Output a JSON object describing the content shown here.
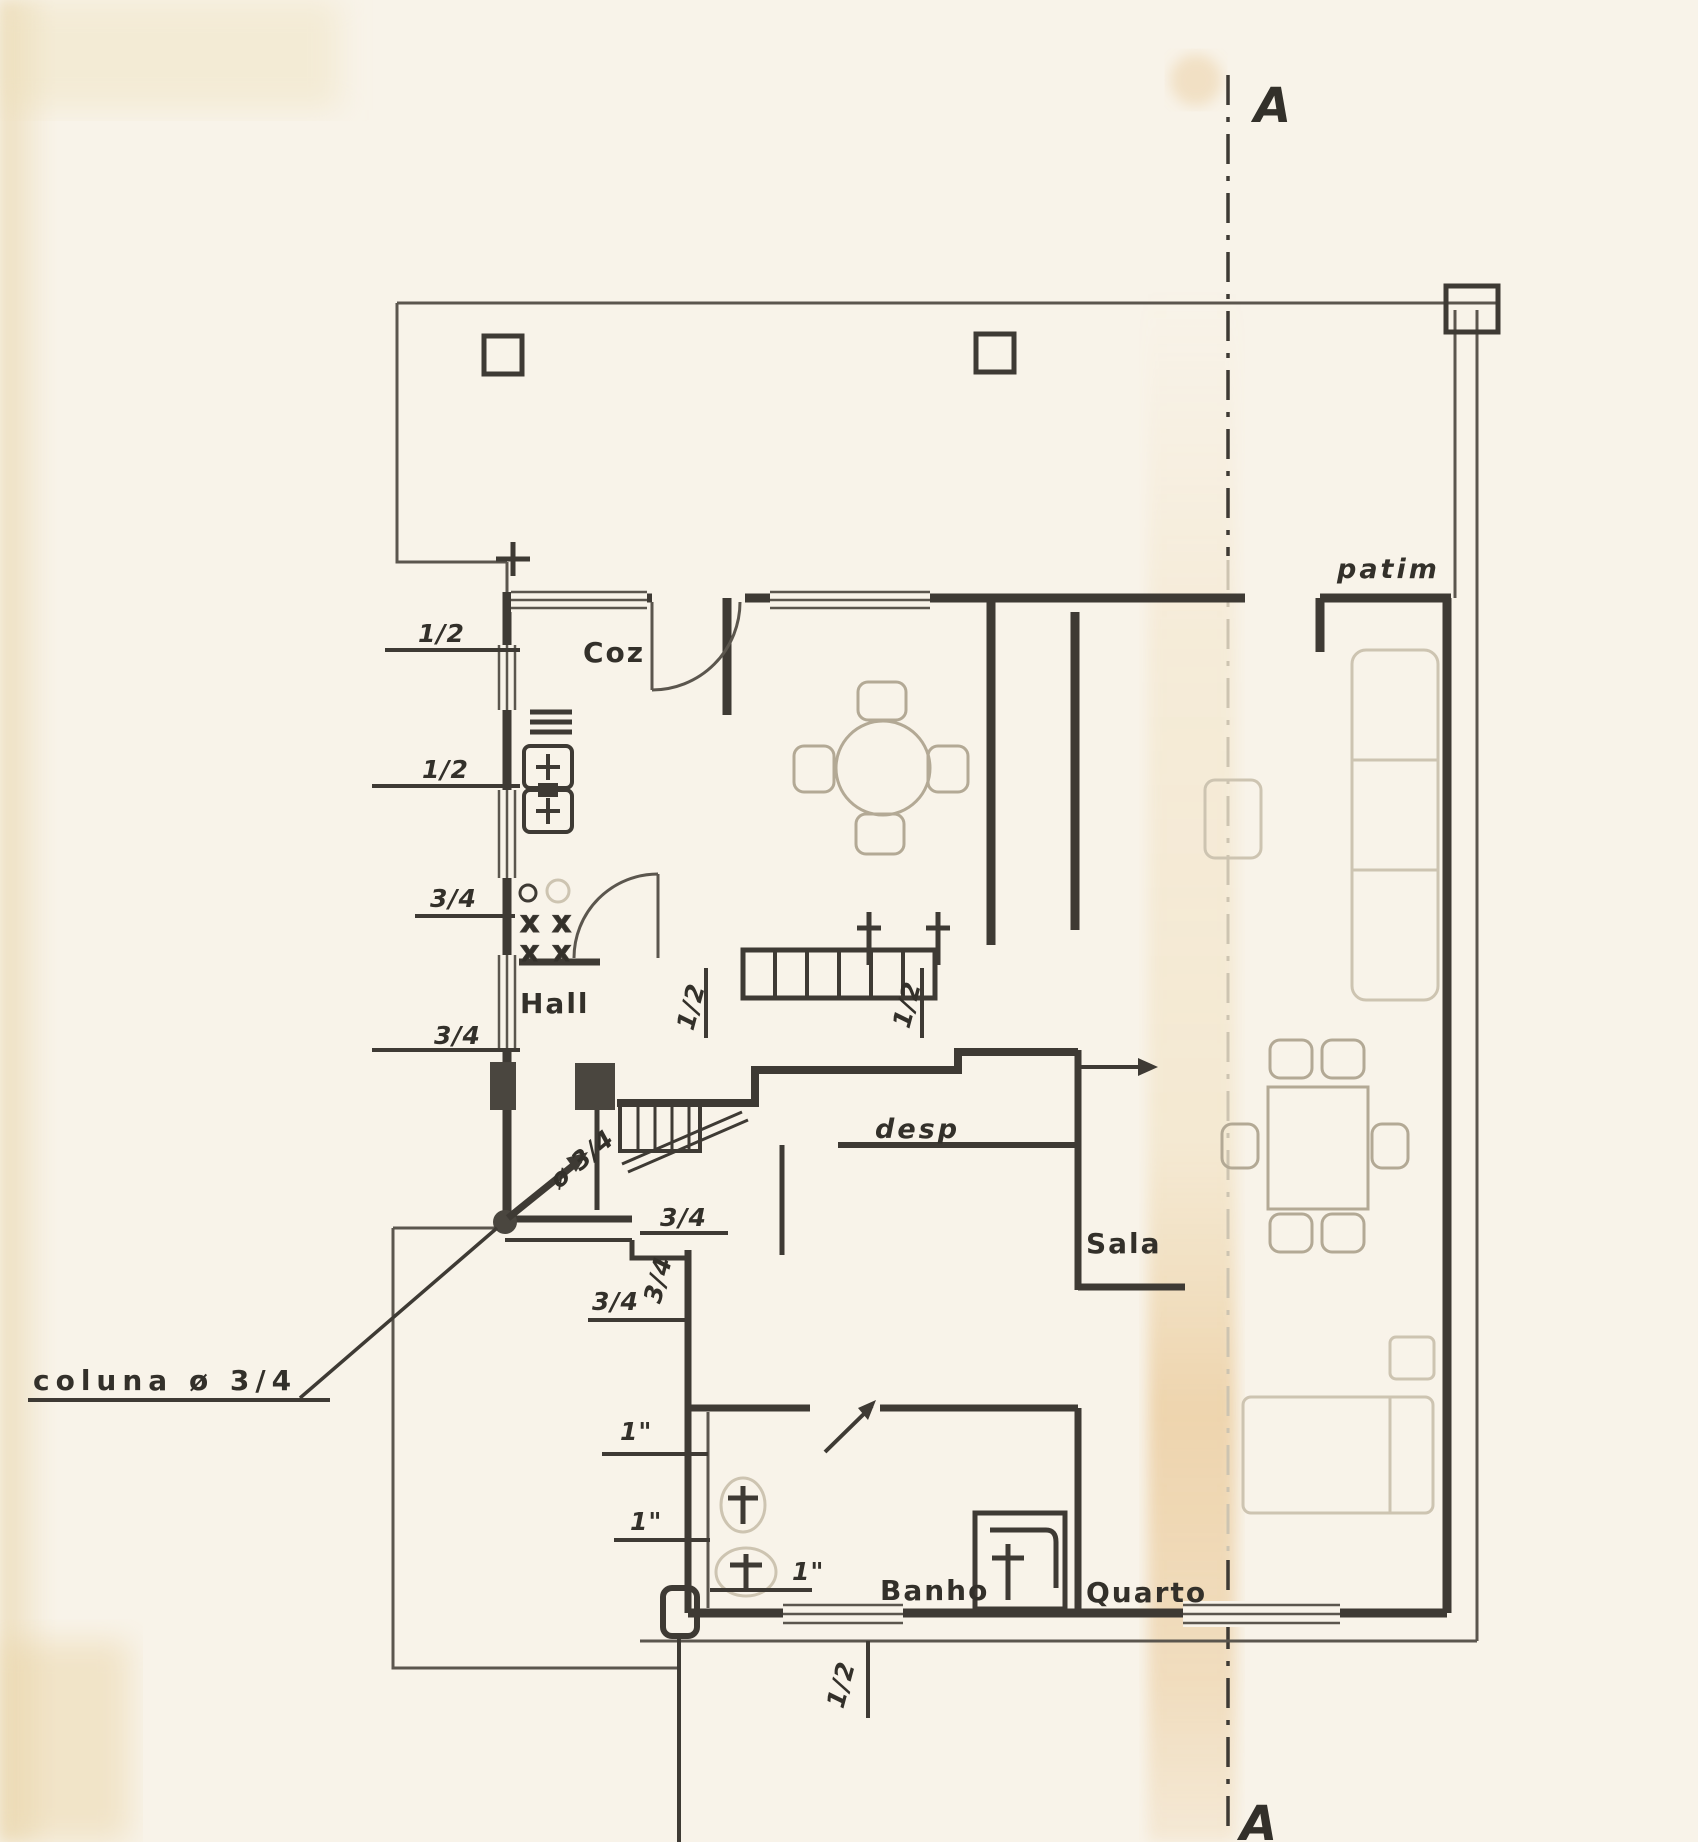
{
  "document": {
    "kind": "scanned hand-drawn floor plan (plumbing layout)",
    "language": "Portuguese"
  },
  "markers": {
    "top": "A",
    "bottom": "A"
  },
  "rooms": {
    "kitchen": "Coz",
    "hall": "Hall",
    "pantry": "desp",
    "living_room": "Sala",
    "bathroom": "Banho",
    "bedroom": "Quarto",
    "landing": "patim"
  },
  "pipes": {
    "west": [
      "1/2",
      "1/2",
      "3/4",
      "3/4"
    ],
    "hall": [
      "1/2",
      "1/2"
    ],
    "stairs": [
      "3/4",
      "3/4",
      "3/4"
    ],
    "bath": [
      "1\"",
      "1\"",
      "1\""
    ],
    "south": "1/2"
  },
  "notes": {
    "column": "coluna  ø 3/4",
    "column_riser": "ø 3/4"
  },
  "colors": {
    "paper": "#f8f3e9",
    "ink": "#3e3a34",
    "pencil": "#b3a995",
    "stain": "#e0aa5c"
  }
}
